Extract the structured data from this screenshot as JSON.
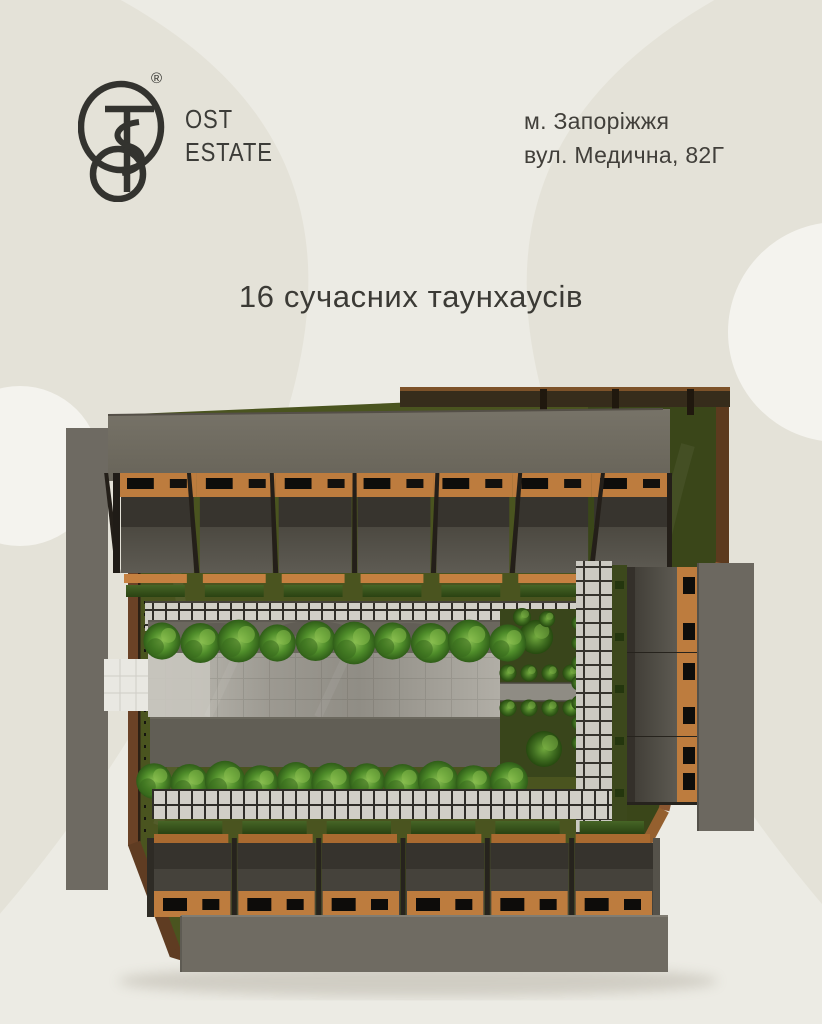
{
  "header": {
    "brand": {
      "line1": "OST",
      "line2": "ESTATE",
      "trademark": "®"
    },
    "address": {
      "line1": "м. Запоріжжя",
      "line2": "вул. Медична, 82Г"
    }
  },
  "headline": "16 сучасних таунхаусів",
  "site_plan": {
    "type": "3d-top-down-site-render",
    "total_units": 16,
    "rows": {
      "top_units": 7,
      "bottom_units": 6,
      "right_units": 3
    },
    "trees": {
      "top_row": 10,
      "middle_row": 11
    },
    "palette": {
      "background": "#ecebe4",
      "background_shade": "#e3e1d6",
      "ink": "#3b3a35",
      "roof_gray": "#6e6a60",
      "facade_orange": "#bd7c3e",
      "wall_dark": "#2f2c26",
      "lawn_green": "#4a541f",
      "garden_green": "#39451b",
      "tree_green": "#4f8d2a",
      "paving_light": "#d1cfc7",
      "wood_brown": "#7a4c26"
    }
  }
}
